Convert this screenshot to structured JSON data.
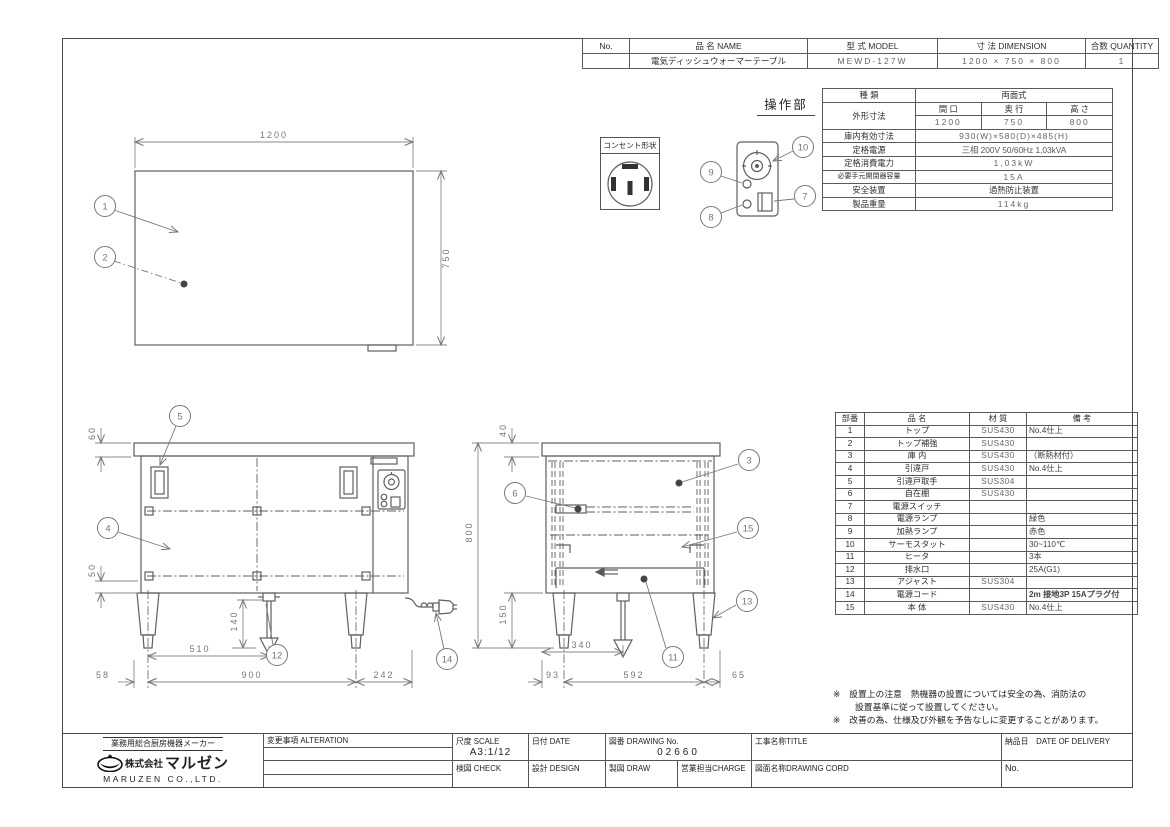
{
  "header_table": {
    "col_no": "No.",
    "col_name": "品 名  NAME",
    "col_model": "型 式  MODEL",
    "col_dim": "寸 法  DIMENSION",
    "col_qty": "合数 QUANTITY",
    "row": {
      "no": "",
      "name": "電気ディッシュウォーマーテーブル",
      "model": "MEWD-127W",
      "dimension": "1200 × 750 × 800",
      "quantity": "1"
    }
  },
  "spec_table": {
    "type_label": "種  類",
    "type_value": "両面式",
    "outer_label": "外形寸法",
    "w_label": "間 口",
    "d_label": "奥 行",
    "h_label": "高 さ",
    "w": "1200",
    "d": "750",
    "h": "800",
    "inner_label": "庫内有効寸法",
    "inner_value": "930(W)×580(D)×485(H)",
    "power_label": "定格電源",
    "power_value": "三相 200V 50/60Hz 1,03kVA",
    "consumption_label": "定格消費電力",
    "consumption_value": "1,03kW",
    "breaker_label": "必要手元開閉器容量",
    "breaker_value": "15A",
    "safety_label": "安全装置",
    "safety_value": "過熱防止装置",
    "weight_label": "製品重量",
    "weight_value": "114kg"
  },
  "parts_table": {
    "h_no": "部番",
    "h_name": "品  名",
    "h_mat": "材 質",
    "h_note": "備  考",
    "rows": [
      {
        "no": "1",
        "name": "トップ",
        "material": "SUS430",
        "note": "No.4仕上"
      },
      {
        "no": "2",
        "name": "トップ補強",
        "material": "SUS430",
        "note": ""
      },
      {
        "no": "3",
        "name": "庫 内",
        "material": "SUS430",
        "note": "（断熱材付）"
      },
      {
        "no": "4",
        "name": "引違戸",
        "material": "SUS430",
        "note": "No.4仕上"
      },
      {
        "no": "5",
        "name": "引違戸取手",
        "material": "SUS304",
        "note": ""
      },
      {
        "no": "6",
        "name": "自在棚",
        "material": "SUS430",
        "note": ""
      },
      {
        "no": "7",
        "name": "電源スイッチ",
        "material": "",
        "note": ""
      },
      {
        "no": "8",
        "name": "電源ランプ",
        "material": "",
        "note": "緑色"
      },
      {
        "no": "9",
        "name": "加熱ランプ",
        "material": "",
        "note": "赤色"
      },
      {
        "no": "10",
        "name": "サーモスタット",
        "material": "",
        "note": "30~110℃"
      },
      {
        "no": "11",
        "name": "ヒータ",
        "material": "",
        "note": "3本"
      },
      {
        "no": "12",
        "name": "排水口",
        "material": "",
        "note": "25A(G1)"
      },
      {
        "no": "13",
        "name": "アジャスト",
        "material": "SUS304",
        "note": ""
      },
      {
        "no": "14",
        "name": "電源コード",
        "material": "",
        "note": "2m 接地3P 15Aプラグ付"
      },
      {
        "no": "15",
        "name": "本 体",
        "material": "SUS430",
        "note": "No.4仕上"
      }
    ]
  },
  "notes": {
    "line1": "※　設置上の注意　熱機器の設置については安全の為、消防法の",
    "line2": "設置基準に従って設置してください。",
    "line3": "※　改善の為、仕様及び外観を予告なしに変更することがあります。"
  },
  "labels": {
    "operation_panel": "操作部",
    "outlet_shape": "コンセント形状"
  },
  "dims": {
    "plan_w": "1200",
    "plan_d": "750",
    "front_top": "60",
    "front_rail": "50",
    "front_drain_h": "140",
    "front_510": "510",
    "front_58": "58",
    "front_900": "900",
    "front_242": "242",
    "side_top": "40",
    "side_h": "800",
    "side_leg": "150",
    "side_340": "340",
    "side_93": "93",
    "side_592": "592",
    "side_65": "65"
  },
  "callouts": [
    "1",
    "2",
    "3",
    "4",
    "5",
    "6",
    "7",
    "8",
    "9",
    "10",
    "11",
    "12",
    "13",
    "14",
    "15"
  ],
  "title_block": {
    "maker_tagline": "業務用総合厨房機器メーカー",
    "company_prefix": "株式会社",
    "company": "マルゼン",
    "company_en": "MARUZEN CO.,LTD.",
    "alteration_label": "変更事項  ALTERATION",
    "scale_label": "尺度 SCALE",
    "scale_value": "A3:1/12",
    "date_label": "日付 DATE",
    "drawing_no_label": "図番 DRAWING No.",
    "drawing_no_value": "02660",
    "title_label": "工事名称TITLE",
    "delivery_label": "納品日　DATE OF DELIVERY",
    "check_label": "検図 CHECK",
    "design_label": "設計 DESIGN",
    "draw_label": "製図 DRAW",
    "charge_label": "営業担当CHARGE",
    "drawing_name_label": "図面名称DRAWING CORD",
    "no_label": "No."
  }
}
